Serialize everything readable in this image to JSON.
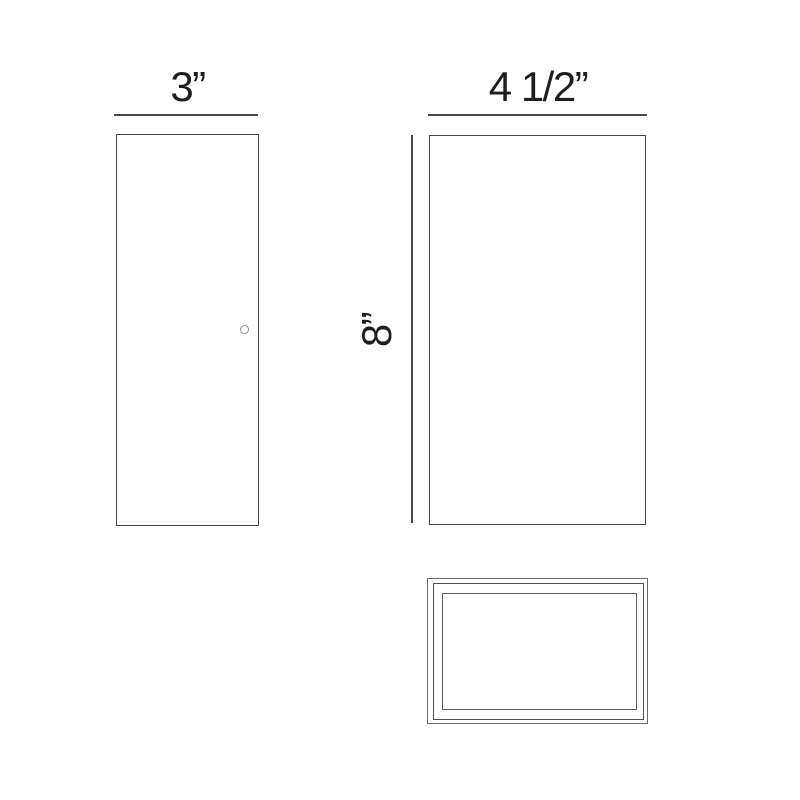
{
  "labels": {
    "front_width": "3”",
    "side_width": "4 1/2”",
    "side_height": "8”"
  },
  "colors": {
    "background": "#ffffff",
    "outline_line": "#474747",
    "dimension_line": "#4a4a4a",
    "top_view_line": "#5d5d5d",
    "label_text": "#1e1e1e",
    "detail_circle": "#8f8f8f"
  }
}
